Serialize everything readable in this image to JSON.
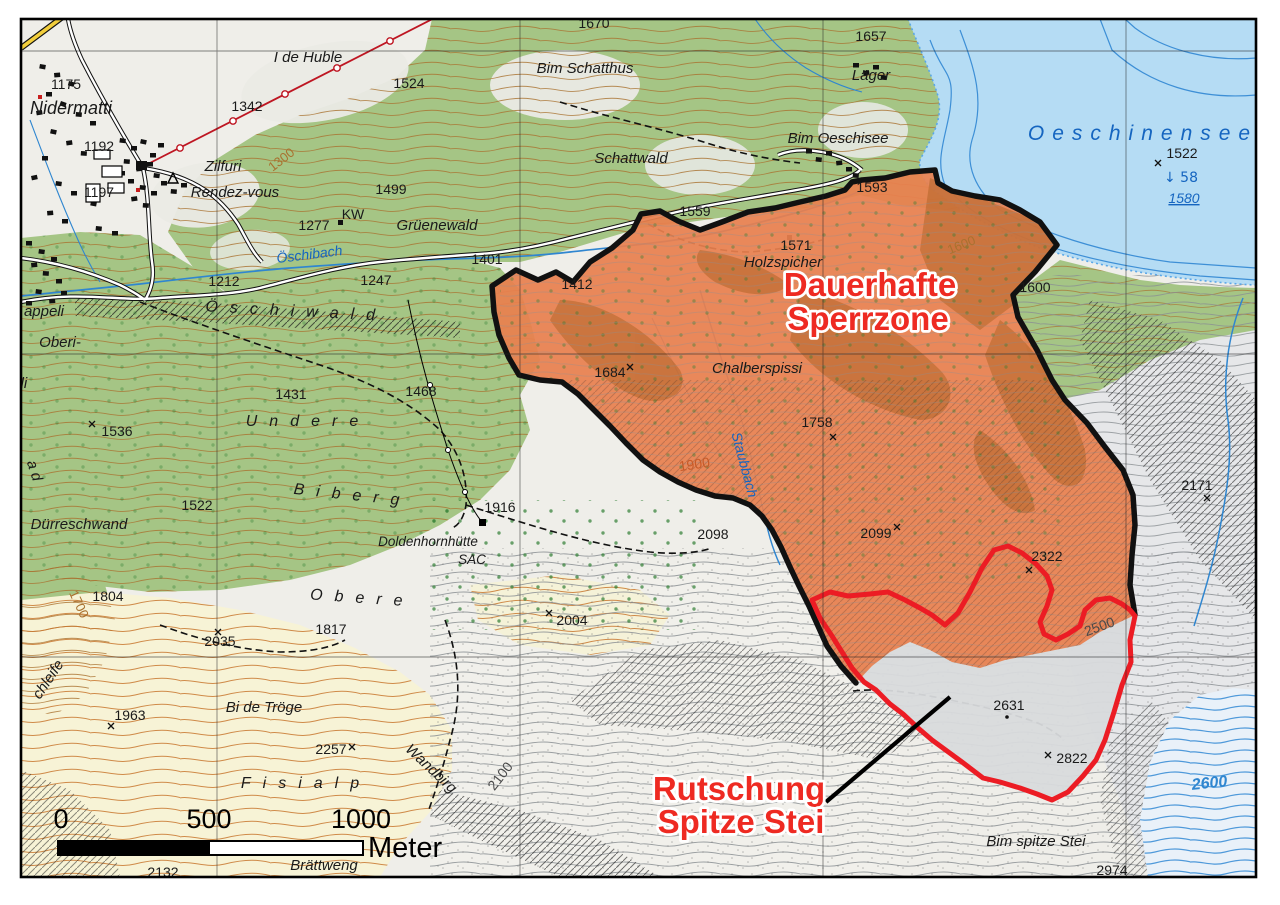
{
  "map": {
    "zones": {
      "permanent_closure_zone": "Dauerhafte Sperrzone",
      "landslide": "Rutschung Spitze Stei"
    },
    "scale_bar": {
      "t0": "0",
      "t1": "500",
      "t2": "1000",
      "unit": "Meter"
    },
    "colors": {
      "zone_fill": "#E8804F",
      "zone_dark_patch": "#AD6223",
      "zone_border": "#111111",
      "landslide_outline": "#EC1C24",
      "warning_label_red": "#EE2A22",
      "lake_fill": "#B5DCF4",
      "water_line": "#3D8FD6",
      "forest_green": "#A5C585",
      "alp_cream": "#F7F3D6",
      "contour_brown": "#A9712F",
      "label_blue": "#1565C0"
    },
    "labels": [
      {
        "t": "Nidermatti",
        "x": 71,
        "y": 114,
        "c": "place-lg"
      },
      {
        "t": "1175",
        "x": 66,
        "y": 89,
        "c": "elev"
      },
      {
        "t": "1192",
        "x": 99,
        "y": 151,
        "c": "elev"
      },
      {
        "t": "1197",
        "x": 99,
        "y": 197,
        "c": "elev"
      },
      {
        "t": "Zilfuri",
        "x": 223,
        "y": 171,
        "c": "place"
      },
      {
        "t": "Rendez-vous",
        "x": 235,
        "y": 197,
        "c": "place"
      },
      {
        "t": "1342",
        "x": 247,
        "y": 111,
        "c": "elev"
      },
      {
        "t": "I de Huble",
        "x": 308,
        "y": 62,
        "c": "place"
      },
      {
        "t": "1524",
        "x": 409,
        "y": 88,
        "c": "elev"
      },
      {
        "t": "1670",
        "x": 594,
        "y": 28,
        "c": "elev"
      },
      {
        "t": "Bim Schatthus",
        "x": 585,
        "y": 73,
        "c": "place"
      },
      {
        "t": "Schattwald",
        "x": 631,
        "y": 163,
        "c": "place"
      },
      {
        "t": "1657",
        "x": 871,
        "y": 41,
        "c": "elev"
      },
      {
        "t": "Läger",
        "x": 871,
        "y": 80,
        "c": "place"
      },
      {
        "t": "Bim Oeschisee",
        "x": 838,
        "y": 143,
        "c": "place"
      },
      {
        "t": "1593",
        "x": 872,
        "y": 192,
        "c": "elev"
      },
      {
        "t": "Oeschinensee",
        "x": 1143,
        "y": 140,
        "c": "lake-name"
      },
      {
        "t": "1522",
        "x": 1182,
        "y": 158,
        "c": "elev"
      },
      {
        "t": "↓ 58",
        "x": 1181,
        "y": 182,
        "c": "lake-blue"
      },
      {
        "t": "1580",
        "x": 1184,
        "y": 203,
        "c": "lake-depth"
      },
      {
        "t": "1499",
        "x": 391,
        "y": 194,
        "c": "elev"
      },
      {
        "t": "KW",
        "x": 353,
        "y": 219,
        "c": "elev"
      },
      {
        "t": "1277",
        "x": 314,
        "y": 230,
        "c": "elev"
      },
      {
        "t": "Grüenewald",
        "x": 437,
        "y": 230,
        "c": "place"
      },
      {
        "t": "1401",
        "x": 487,
        "y": 264,
        "c": "elev"
      },
      {
        "t": "Öschibach",
        "x": 310,
        "y": 259,
        "c": "water",
        "r": -7
      },
      {
        "t": "1212",
        "x": 224,
        "y": 286,
        "c": "elev"
      },
      {
        "t": "1247",
        "x": 376,
        "y": 285,
        "c": "elev"
      },
      {
        "t": "Öschiwald",
        "x": 296,
        "y": 316,
        "c": "spaced",
        "r": 3
      },
      {
        "t": "appeli",
        "x": 44,
        "y": 316,
        "c": "place"
      },
      {
        "t": "Oberi-",
        "x": 60,
        "y": 347,
        "c": "place"
      },
      {
        "t": "ildi",
        "x": 18,
        "y": 388,
        "c": "place"
      },
      {
        "t": "1559",
        "x": 695,
        "y": 216,
        "c": "elev"
      },
      {
        "t": "1571",
        "x": 796,
        "y": 250,
        "c": "elev"
      },
      {
        "t": "Holzspicher",
        "x": 783,
        "y": 267,
        "c": "place"
      },
      {
        "t": "1412",
        "x": 577,
        "y": 289,
        "c": "elev"
      },
      {
        "t": "1600",
        "x": 963,
        "y": 249,
        "c": "cbrown",
        "r": -22
      },
      {
        "t": "1600",
        "x": 1035,
        "y": 292,
        "c": "elev"
      },
      {
        "t": "1300",
        "x": 284,
        "y": 163,
        "c": "cbrown",
        "r": -38
      },
      {
        "t": "1431",
        "x": 291,
        "y": 399,
        "c": "elev"
      },
      {
        "t": "1468",
        "x": 421,
        "y": 396,
        "c": "elev"
      },
      {
        "t": "Undere",
        "x": 308,
        "y": 426,
        "c": "spaced"
      },
      {
        "t": "1536",
        "x": 117,
        "y": 436,
        "c": "elev"
      },
      {
        "t": "1684",
        "x": 610,
        "y": 377,
        "c": "elev"
      },
      {
        "t": "Chalberspissi",
        "x": 757,
        "y": 373,
        "c": "place"
      },
      {
        "t": "1758",
        "x": 817,
        "y": 427,
        "c": "elev"
      },
      {
        "t": "Staubbach",
        "x": 740,
        "y": 466,
        "c": "water",
        "r": 75
      },
      {
        "t": "1900",
        "x": 695,
        "y": 469,
        "c": "corange",
        "r": -8
      },
      {
        "t": "1522",
        "x": 197,
        "y": 510,
        "c": "elev"
      },
      {
        "t": "Biberg",
        "x": 352,
        "y": 500,
        "c": "spaced",
        "r": 6
      },
      {
        "t": "Dürreschwand",
        "x": 79,
        "y": 529,
        "c": "place"
      },
      {
        "t": "Doldenhornhütte",
        "x": 428,
        "y": 546,
        "c": "place-sm"
      },
      {
        "t": "SAC",
        "x": 472,
        "y": 564,
        "c": "place-sm"
      },
      {
        "t": "1916",
        "x": 500,
        "y": 512,
        "c": "elev"
      },
      {
        "t": "2098",
        "x": 713,
        "y": 539,
        "c": "elev"
      },
      {
        "t": "2099",
        "x": 876,
        "y": 538,
        "c": "elev"
      },
      {
        "t": "2171",
        "x": 1197,
        "y": 490,
        "c": "elev"
      },
      {
        "t": "2322",
        "x": 1047,
        "y": 561,
        "c": "elev"
      },
      {
        "t": "1700",
        "x": 75,
        "y": 606,
        "c": "cbrown",
        "r": 65
      },
      {
        "t": "a d",
        "x": 30,
        "y": 472,
        "c": "place",
        "r": 72
      },
      {
        "t": "chleife",
        "x": 52,
        "y": 682,
        "c": "place",
        "r": -56
      },
      {
        "t": "1804",
        "x": 108,
        "y": 601,
        "c": "elev"
      },
      {
        "t": "2035",
        "x": 220,
        "y": 646,
        "c": "elev"
      },
      {
        "t": "1817",
        "x": 331,
        "y": 634,
        "c": "elev"
      },
      {
        "t": "Obere",
        "x": 362,
        "y": 603,
        "c": "spaced",
        "r": 4
      },
      {
        "t": "2004",
        "x": 572,
        "y": 625,
        "c": "elev"
      },
      {
        "t": "2500",
        "x": 1101,
        "y": 631,
        "c": "cgray",
        "r": -20
      },
      {
        "t": "1963",
        "x": 130,
        "y": 720,
        "c": "elev"
      },
      {
        "t": "Bi de Tröge",
        "x": 264,
        "y": 712,
        "c": "place"
      },
      {
        "t": "2257",
        "x": 331,
        "y": 754,
        "c": "elev"
      },
      {
        "t": "Wandbirg",
        "x": 428,
        "y": 772,
        "c": "place",
        "r": 43
      },
      {
        "t": "2100",
        "x": 504,
        "y": 779,
        "c": "cgray",
        "r": -52
      },
      {
        "t": "Fisialp",
        "x": 306,
        "y": 788,
        "c": "spaced"
      },
      {
        "t": "2631",
        "x": 1009,
        "y": 710,
        "c": "elev"
      },
      {
        "t": "2822",
        "x": 1072,
        "y": 763,
        "c": "elev"
      },
      {
        "t": "2600",
        "x": 1210,
        "y": 788,
        "c": "cblue",
        "r": -6
      },
      {
        "t": "Bim spitze Stei",
        "x": 1036,
        "y": 846,
        "c": "place"
      },
      {
        "t": "2974",
        "x": 1112,
        "y": 875,
        "c": "elev"
      },
      {
        "t": "Brättweng",
        "x": 324,
        "y": 870,
        "c": "place"
      },
      {
        "t": "2132",
        "x": 163,
        "y": 877,
        "c": "elev"
      },
      {
        "t": "Dauerhafte",
        "x": 870,
        "y": 296,
        "c": "red"
      },
      {
        "t": "Sperrzone",
        "x": 868,
        "y": 330,
        "c": "red"
      },
      {
        "t": "Rutschung",
        "x": 739,
        "y": 800,
        "c": "red"
      },
      {
        "t": "Spitze Stei",
        "x": 741,
        "y": 833,
        "c": "red"
      }
    ],
    "spot_marks": [
      [
        92,
        424
      ],
      [
        111,
        726
      ],
      [
        218,
        632
      ],
      [
        352,
        747
      ],
      [
        549,
        613
      ],
      [
        630,
        367
      ],
      [
        833,
        437
      ],
      [
        897,
        527
      ],
      [
        1207,
        498
      ],
      [
        1029,
        570
      ],
      [
        1048,
        755
      ],
      [
        1158,
        163
      ]
    ]
  }
}
